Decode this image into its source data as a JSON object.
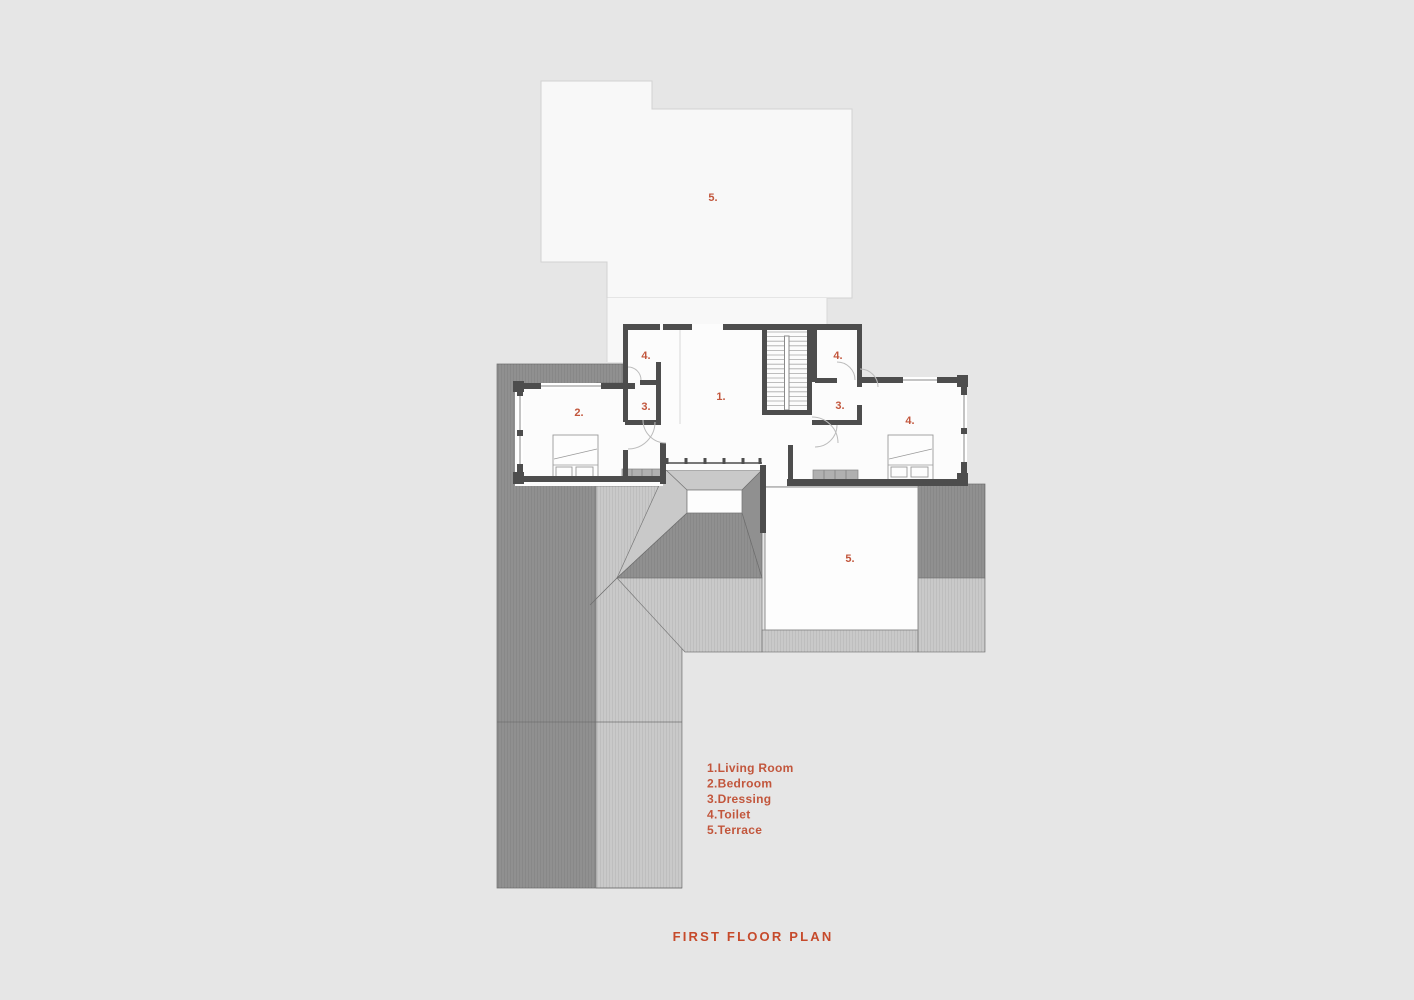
{
  "title": "FIRST FLOOR PLAN",
  "colors": {
    "accent": "#c2563c",
    "title_color": "#c64a2b",
    "wall": "#4d4d4d",
    "roof_dark": "#909090",
    "roof_light": "#c9c9c9",
    "background": "#e6e6e6",
    "paper": "#f8f8f8",
    "room_fill": "#fcfcfc"
  },
  "rooms": {
    "terrace_top": "5.",
    "toilet_left": "4.",
    "dressing_left": "3.",
    "bedroom_left": "2.",
    "living": "1.",
    "toilet_right": "4.",
    "dressing_right": "3.",
    "bedroom_right": "4.",
    "terrace_bottom": "5."
  },
  "legend": {
    "items": [
      "1.Living Room",
      "2.Bedroom",
      "3.Dressing",
      "4.Toilet",
      "5.Terrace"
    ]
  }
}
